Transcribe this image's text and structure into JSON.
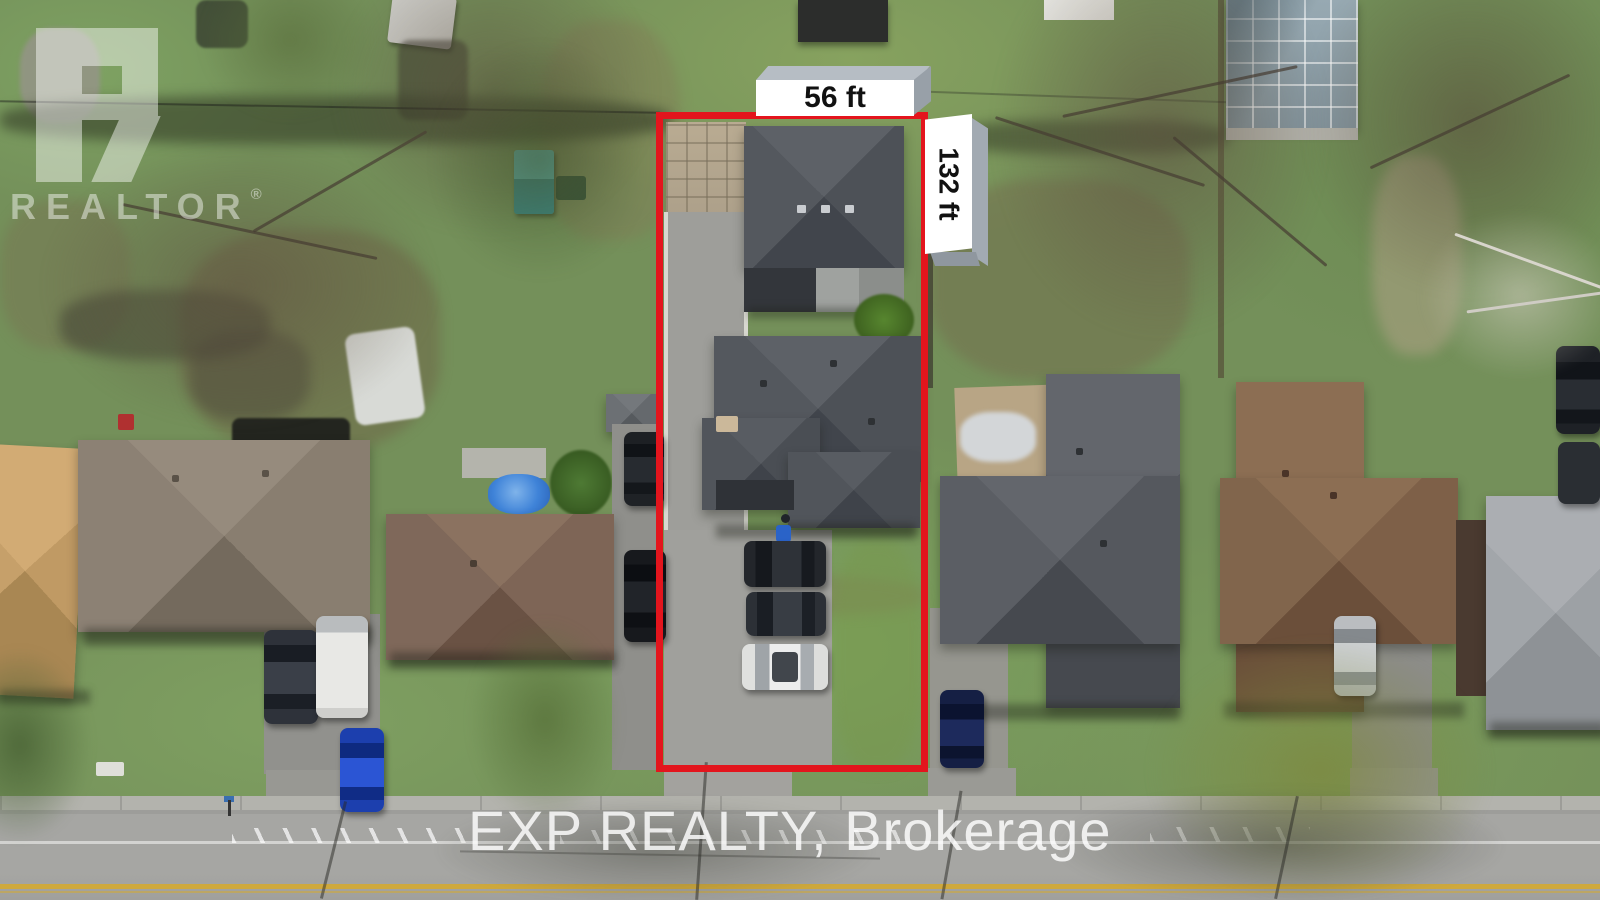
{
  "annotations": {
    "frontage_label": "56 ft",
    "depth_label": "132 ft",
    "boundary_color": "#e3151d",
    "label_bg_color": "#ffffff",
    "label_text_color": "#111111"
  },
  "watermarks": {
    "logo_text": "REALTOR",
    "registered_mark": "®",
    "brokerage_text": "EXP REALTY, Brokerage",
    "watermark_color": "#ffffff"
  }
}
